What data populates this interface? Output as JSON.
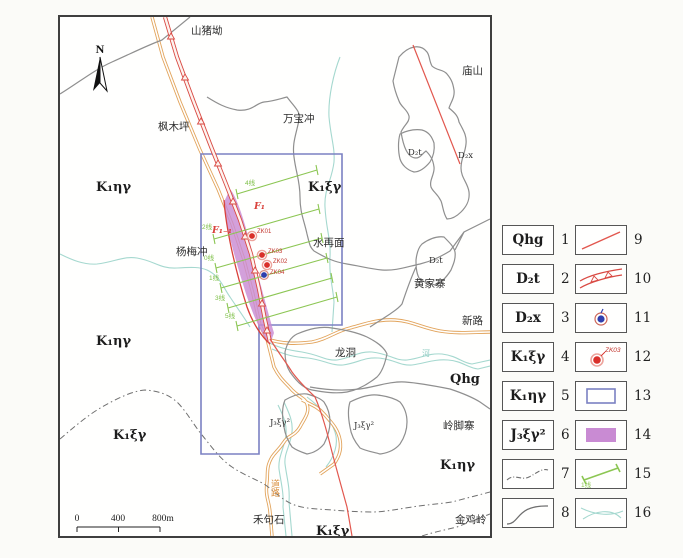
{
  "map": {
    "north_label": "N",
    "scale_bar": {
      "zero": "0",
      "four_hundred": "400",
      "eight_hundred": "800m"
    },
    "place_names": {
      "shanzhuao": "山猪坳",
      "miaoshan": "庙山",
      "fengmuping": "枫木坪",
      "wanbaochong": "万宝冲",
      "yangmeichong": "杨梅冲",
      "shuizaimian": "水再面",
      "huangjiazhai": "黄家寨",
      "xinlu": "新路",
      "longdong": "龙洞",
      "lingjiaozhai": "岭脚寨",
      "jinjiling": "金鸡岭",
      "hejushi": "禾句石"
    },
    "road_label": "道路",
    "river_label": "河",
    "unit_labels": {
      "k1hy_nw": "K₁ηγ",
      "k1xy_ne": "K₁ξγ",
      "k1hy_w": "K₁ηγ",
      "k1xy_sw": "K₁ξγ",
      "qhg": "Qhg",
      "k1hy_se": "K₁ηγ",
      "k1xy_s": "K₁ξγ",
      "d2t_ne": "D₂t",
      "d2x_ne": "D₂x",
      "d2t_center": "D₂t",
      "j3xy2_w": "J₃ξγ²",
      "j3xy2_e": "J₃ξγ²"
    },
    "fault_labels": {
      "f1": "F₁",
      "f1_1": "F₁₋₁"
    },
    "drillholes": [
      {
        "id": "ZK01",
        "kind": "ore"
      },
      {
        "id": "ZK03",
        "kind": "ore"
      },
      {
        "id": "ZK02",
        "kind": "ore"
      },
      {
        "id": "ZK04",
        "kind": "barren"
      }
    ],
    "survey_line_labels": [
      "4线",
      "2线",
      "0线",
      "1线",
      "3线",
      "5线"
    ]
  },
  "legend": {
    "items": [
      {
        "num": "1",
        "label": "Qhg",
        "symbol": "unit-quaternary"
      },
      {
        "num": "2",
        "label": "D₂t",
        "symbol": "unit-d2t"
      },
      {
        "num": "3",
        "label": "D₂x",
        "symbol": "unit-d2x"
      },
      {
        "num": "4",
        "label": "K₁ξγ",
        "symbol": "unit-k1xy"
      },
      {
        "num": "5",
        "label": "K₁ηγ",
        "symbol": "unit-k1hy"
      },
      {
        "num": "6",
        "label": "J₃ξγ²",
        "symbol": "unit-j3xy2"
      },
      {
        "num": "7",
        "label": "",
        "symbol": "phase-boundary-dashdot"
      },
      {
        "num": "8",
        "label": "",
        "symbol": "geological-boundary"
      },
      {
        "num": "9",
        "label": "",
        "symbol": "fault-line"
      },
      {
        "num": "10",
        "label": "",
        "symbol": "fault-zone"
      },
      {
        "num": "11",
        "label": "",
        "symbol": "drillhole-barren"
      },
      {
        "num": "12",
        "label": "",
        "sublabel": "ZK03",
        "symbol": "drillhole-ore"
      },
      {
        "num": "13",
        "label": "",
        "symbol": "study-area-outline"
      },
      {
        "num": "14",
        "label": "",
        "symbol": "ore-body"
      },
      {
        "num": "15",
        "label": "",
        "sublabel": "1线",
        "symbol": "exploration-line"
      },
      {
        "num": "16",
        "label": "",
        "symbol": "stream"
      }
    ]
  },
  "colors": {
    "fault_red": "#d94a43",
    "road_orange": "#e2a45c",
    "stream_teal": "#a5d8cf",
    "ore_purple": "#c98bd3",
    "study_blue": "#7b81c2",
    "survey_green": "#8cc653",
    "drill_blue": "#2f3fae",
    "boundary_gray": "#8f8f8f"
  }
}
